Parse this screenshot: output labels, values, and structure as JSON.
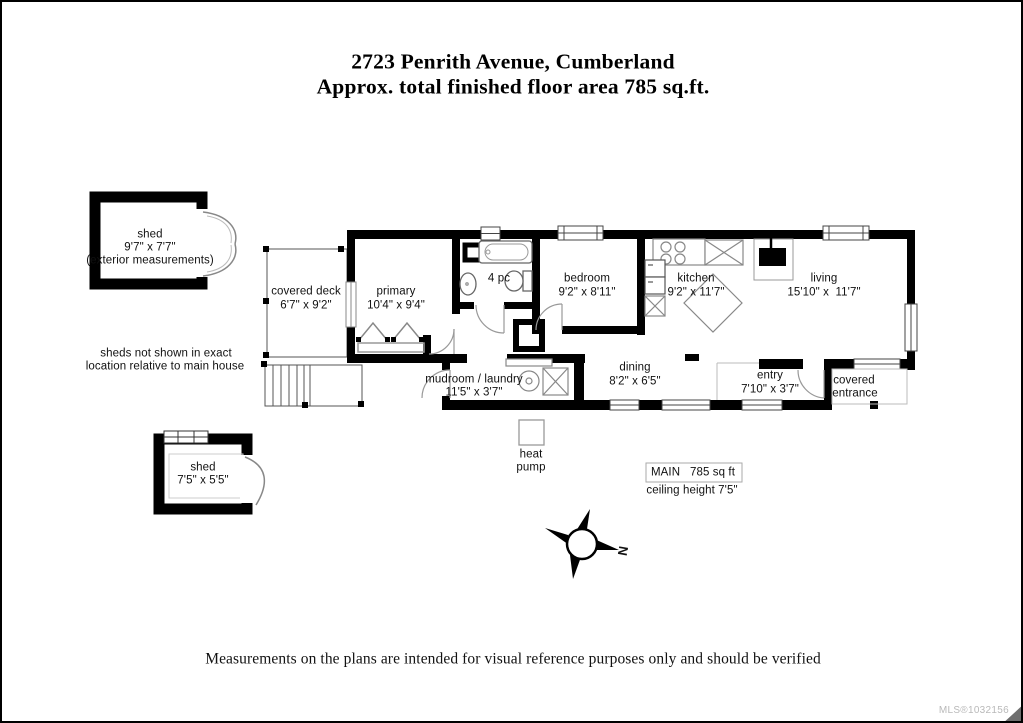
{
  "page": {
    "title_line1": "2723 Penrith Avenue, Cumberland",
    "title_line2": "Approx. total finished floor area 785 sq.ft.",
    "disclaimer": "Measurements on the plans are intended for visual reference purposes only and should be verified",
    "mls": "MLS®1032156"
  },
  "sheds": {
    "shed1": {
      "name": "shed",
      "dims": "9'7\" x 7'7\"",
      "note": "(exterior measurements)"
    },
    "shed2": {
      "name": "shed",
      "dims": "7'5\" x 5'5\""
    },
    "note_line1": "sheds not shown in exact",
    "note_line2": "location relative to main house"
  },
  "rooms": {
    "covered_deck": {
      "name": "covered deck",
      "dims": "6'7\" x 9'2\""
    },
    "primary": {
      "name": "primary",
      "dims": "10'4\" x 9'4\""
    },
    "bath": {
      "name": "4 pc"
    },
    "bedroom": {
      "name": "bedroom",
      "dims": "9'2\" x 8'11\""
    },
    "kitchen": {
      "name": "kitchen",
      "dims": "9'2\" x 11'7\""
    },
    "living": {
      "name": "living",
      "dims": "15'10\" x  11'7\""
    },
    "mudroom": {
      "name": "mudroom / laundry",
      "dims": "11'5\" x 3'7\""
    },
    "dining": {
      "name": "dining",
      "dims": "8'2\" x 6'5\""
    },
    "entry": {
      "name": "entry",
      "dims": "7'10\" x 3'7\""
    },
    "covered_entrance_line1": "covered",
    "covered_entrance_line2": "entrance",
    "heat_pump_line1": "heat",
    "heat_pump_line2": "pump"
  },
  "summary": {
    "main_line": "MAIN   785 sq ft",
    "ceiling_line": "ceiling height 7'5\""
  },
  "compass": {
    "north": "N"
  },
  "colors": {
    "wall": "#000000",
    "fixture_line": "#8a8a8a",
    "window_frame": "#444444"
  }
}
